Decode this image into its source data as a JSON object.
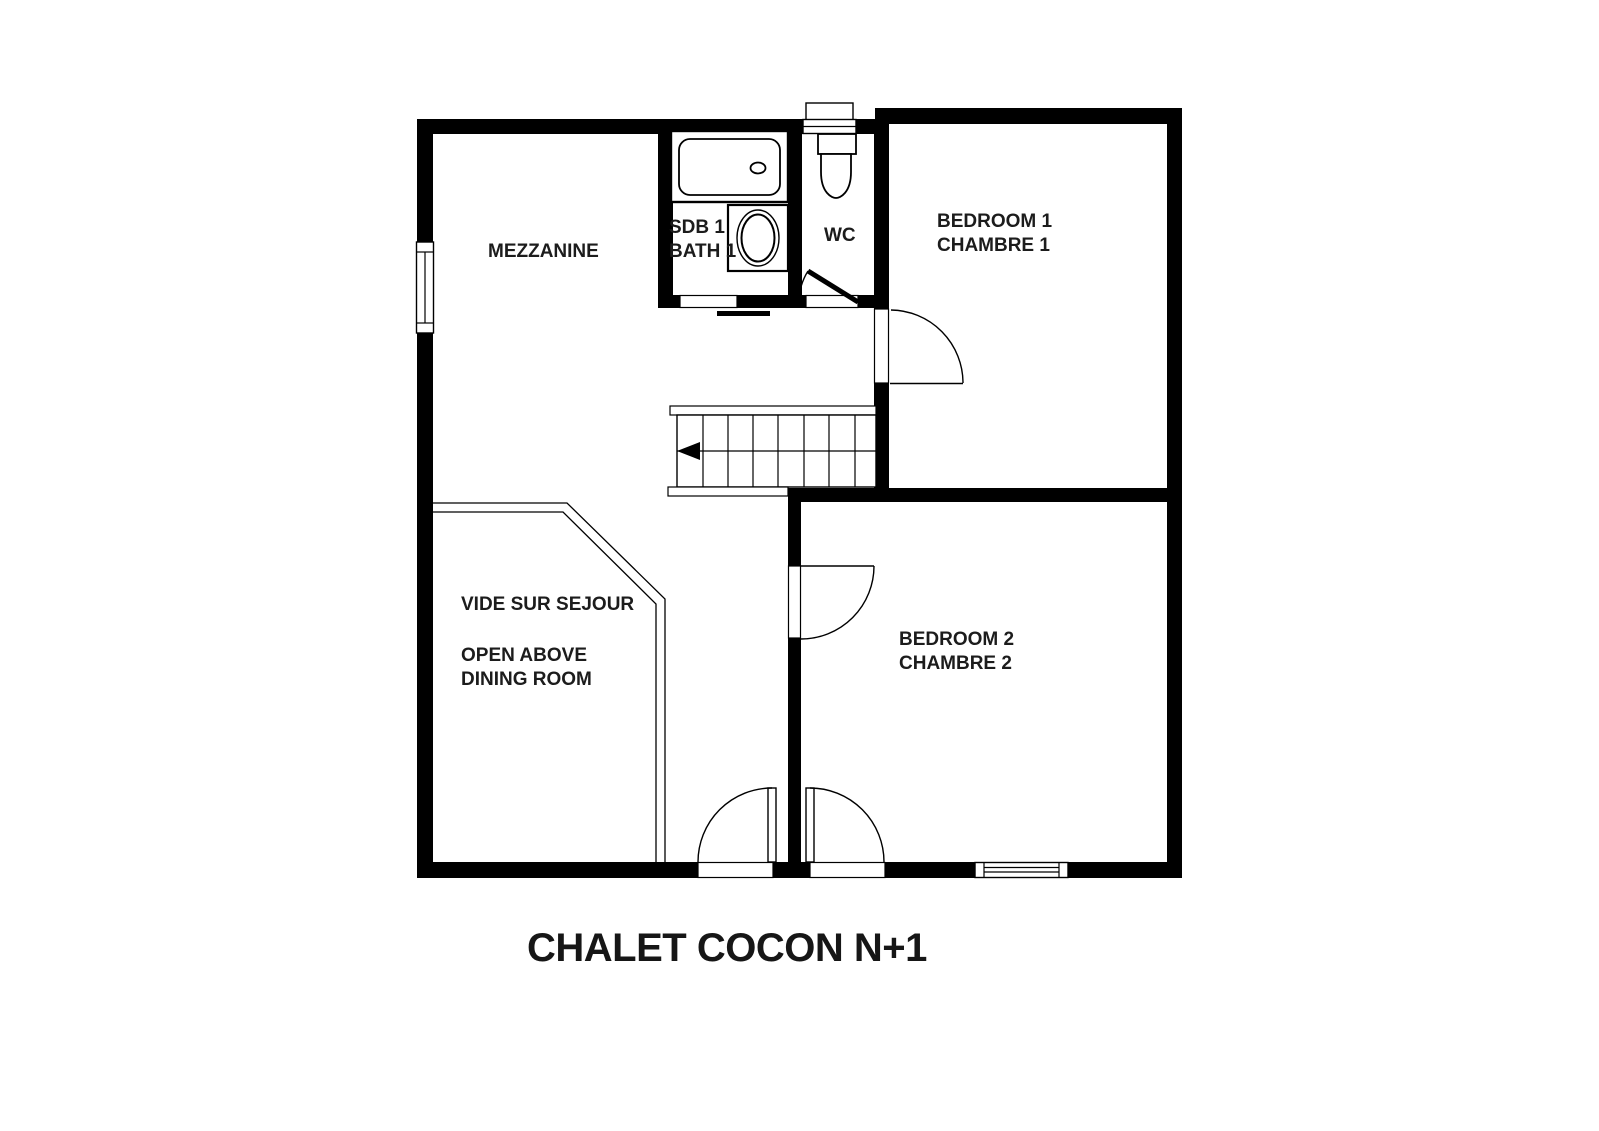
{
  "title": "CHALET COCON N+1",
  "labels": {
    "mezzanine": "MEZZANINE",
    "bath1_line1": "SDB 1",
    "bath1_line2": "BATH 1",
    "wc": "WC",
    "bedroom1_line1": "BEDROOM 1",
    "bedroom1_line2": "CHAMBRE 1",
    "void_line1": "VIDE SUR SEJOUR",
    "void_line2": "OPEN ABOVE DINING ROOM",
    "bedroom2_line1": "BEDROOM 2",
    "bedroom2_line2": "CHAMBRE 2"
  },
  "colors": {
    "wall": "#000000",
    "background": "#ffffff",
    "line": "#000000",
    "text": "#1c1c1c"
  }
}
